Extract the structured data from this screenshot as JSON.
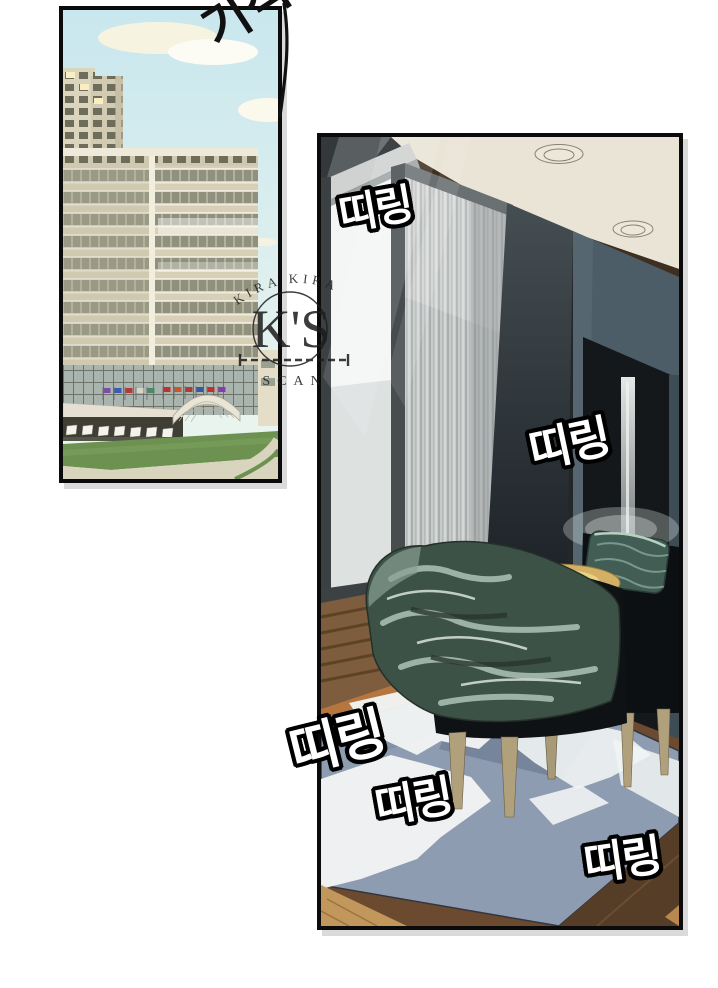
{
  "page": {
    "background_color": "#ffffff",
    "kind": "webtoon-comic-page"
  },
  "sfx": {
    "presence": {
      "text": "기척",
      "style": "black handwritten, top-right, partially cut off"
    },
    "ttiring_1": {
      "text": "띠링"
    },
    "ttiring_2": {
      "text": "띠링"
    },
    "ttiring_3": {
      "text": "띠링"
    },
    "ttiring_4": {
      "text": "띠링"
    },
    "ttiring_5": {
      "text": "띠링"
    },
    "sfx_text_color": "#ffffff",
    "sfx_outline_color": "#000000"
  },
  "watermark": {
    "top_arc_text": "KIRA KIRA",
    "monogram": "K'S",
    "bottom_text": "SCAN",
    "color": "#1c1c1c"
  },
  "panel_building": {
    "scene": "hotel exterior with tower, flags, entrance canopy and lawn under blue sky",
    "colors": {
      "sky_top": "#c9e7ee",
      "sky_bottom": "#eef6ee",
      "cloud": "#f7f3e1",
      "building_face": "#d7d0b7",
      "window_band": "#90907e",
      "lawn": "#6d9150",
      "driveway": "#d9d4be"
    }
  },
  "panel_room": {
    "scene": "hotel room interior with sheer curtains, two dark armchairs, brass side table, draped green blanket and blue-grey rug in sunlight",
    "colors": {
      "ceiling": "#eae4d6",
      "ceiling_trim": "#3f2f20",
      "slate_wall": "#4d5d68",
      "shadow_dark": "#15181b",
      "curtain": "#c7cbca",
      "rug": "#8d9cb1",
      "sunlight": "#f1f4f4",
      "wood_floor": "#b5763f",
      "table_brass": "#d3b065",
      "blanket_green": "#3d5247",
      "pillow_teal": "#415d54"
    }
  }
}
